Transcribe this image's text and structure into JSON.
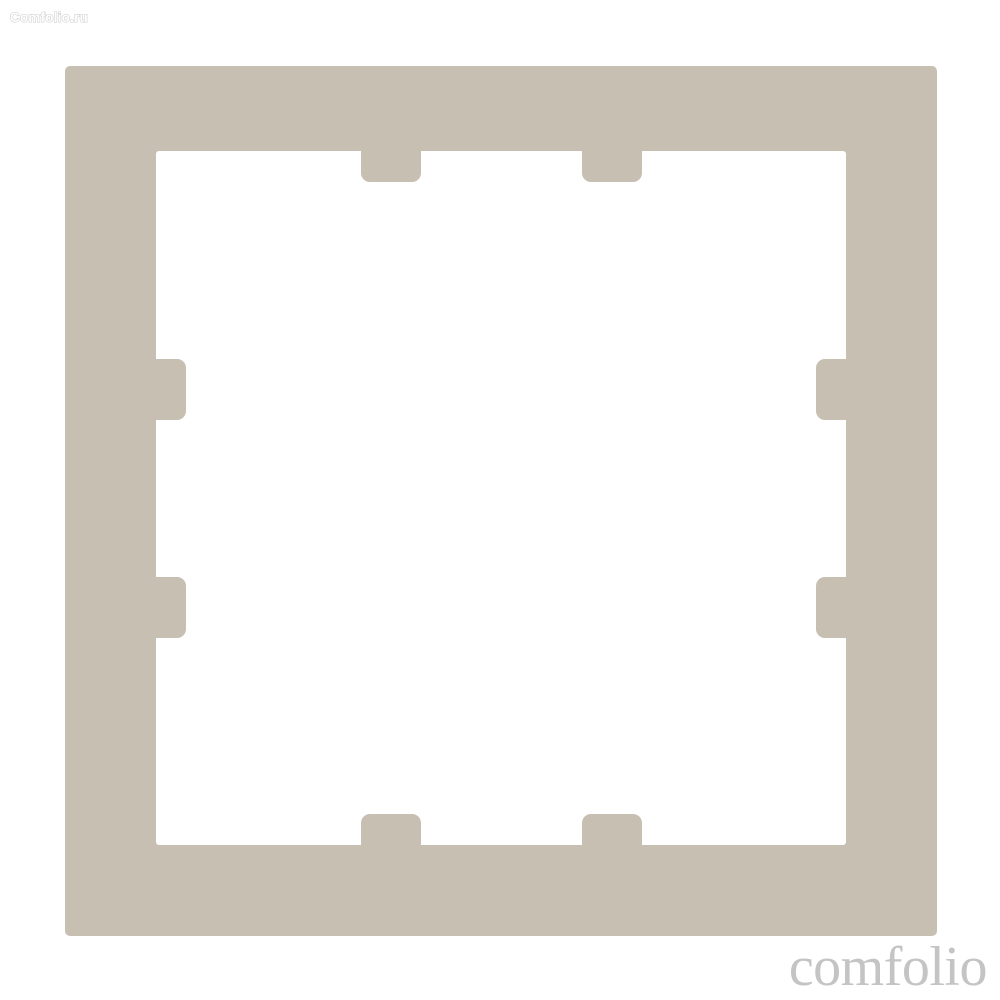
{
  "watermarks": {
    "top_left": "Comfolio.ru",
    "bottom_right": "comfolio"
  },
  "colors": {
    "background": "#ffffff",
    "frame_beige": "#c7bfb1",
    "opening_white": "#ffffff",
    "watermark_outline": "#cccccc",
    "watermark_fill": "#ffffff",
    "watermark_serif_gray": "#c4c4c4"
  }
}
